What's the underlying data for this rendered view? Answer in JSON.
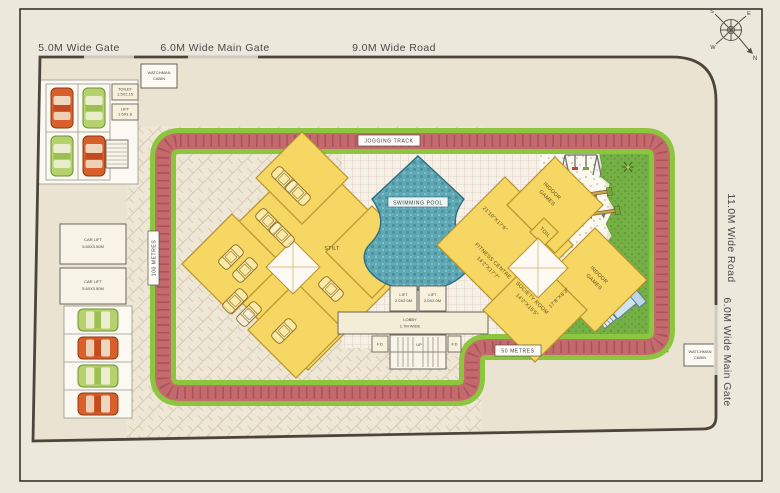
{
  "labels": {
    "gate_small": "5.0M Wide Gate",
    "gate_main_top": "6.0M Wide Main Gate",
    "road_top": "9.0M Wide Road",
    "road_right": "11.0M Wide Road",
    "gate_main_right": "6.0M Wide Main Gate",
    "jogging_track": "JOGGING TRACK",
    "fifty_metres": "50 METRES",
    "hundred_metres": "100 METRES",
    "stilt": "STILT",
    "swimming_pool": "SWIMMING POOL"
  },
  "cabin": {
    "line1": "WATCHMAN",
    "line2": "CABIN"
  },
  "rooms": {
    "dim_a": "21'10\"X17'6\"",
    "indoor1": "INDOOR",
    "indoor2": "GAMES",
    "fitness1": "FITNESS CENTRE",
    "fitness2": "14'2\"X17'7\"",
    "society1": "SOCIETY ROOM",
    "society2": "14'2\"X15'5\"",
    "dim_b": "17'8\"X8'3\"",
    "toil": "TOIL"
  },
  "lobby": {
    "line1": "LOBBY",
    "line2": "1.7M WIDE",
    "lift": "LIFT",
    "lift_dim": "2.0X2.0M",
    "fd": "F.D",
    "up": "UP"
  },
  "service": {
    "toilet": "TOILET",
    "toilet_dim": "1.5X2.15",
    "lift": "LIFT",
    "lift_dim": "1.5X1.8",
    "carlift1": "CAR LIFT",
    "carlift2": "5.60X3.50M"
  },
  "compass": {
    "n": "N",
    "e": "E",
    "s": "S",
    "w": "W"
  },
  "colors": {
    "paper": "#ece8dc",
    "plot": "#eae3d2",
    "boundary": "#4d453c",
    "track": "#c46a6d",
    "track_green": "#8cc63e",
    "building_yellow": "#f6d763",
    "building_outline": "#b8922e",
    "pool_water": "#5fa8b4",
    "grass": "#74b045",
    "car_orange": "#d95f2b",
    "car_green": "#b5d26e"
  }
}
